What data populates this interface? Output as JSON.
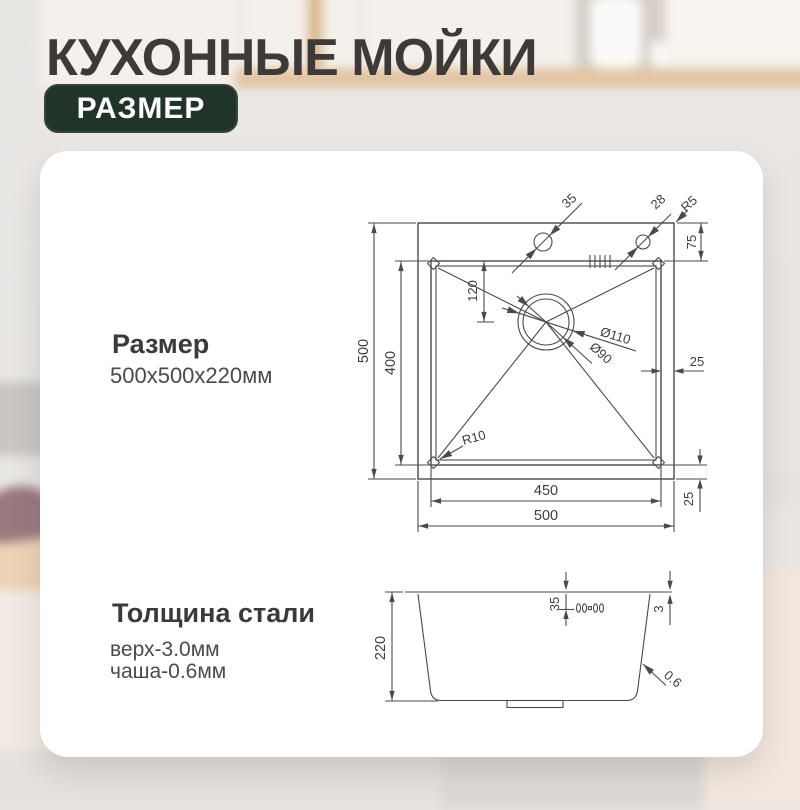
{
  "header": {
    "title": "КУХОННЫЕ МОЙКИ",
    "badge": "РАЗМЕР"
  },
  "size_section": {
    "heading": "Размер",
    "value": "500x500x220мм"
  },
  "thickness_section": {
    "heading": "Толщина стали",
    "line1": "верх-3.0мм",
    "line2": "чаша-0.6мм"
  },
  "top_view": {
    "labels": {
      "outer_height": "500",
      "inner_height": "400",
      "drain_offset": "120",
      "hole_left": "35",
      "hole_right": "28",
      "corner_radius_outer": "R5",
      "deck_width": "75",
      "drain_outer": "Ø110",
      "drain_inner": "Ø90",
      "corner_radius_bowl": "R10",
      "edge_right": "25",
      "edge_bottom": "25",
      "inner_width": "450",
      "outer_width": "500"
    }
  },
  "side_view": {
    "labels": {
      "height": "220",
      "overflow_offset": "35",
      "deck_thickness": "3",
      "wall_thickness": "0.6"
    }
  },
  "colors": {
    "badge_bg": "#20342a",
    "title_text": "#3e3a37",
    "drawing_line": "#4a4a4a",
    "card_bg": "#ffffff"
  }
}
